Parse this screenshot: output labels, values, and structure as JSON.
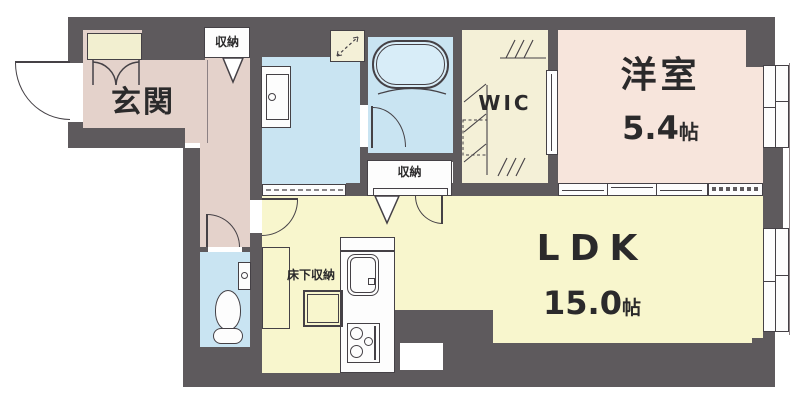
{
  "title": "apartment-floor-plan",
  "colors": {
    "wall": "#5e5a5d",
    "line": "#454146",
    "genkan": "#e4d2cb",
    "bedroom": "#f7e5dc",
    "ldk": "#f8f6cd",
    "wet": "#c9e4f2",
    "wic": "#f4f0d7",
    "cabinet": "#f2efd0",
    "tub": "#d8edf8"
  },
  "rooms": {
    "genkan": {
      "label": "玄関"
    },
    "hall_closet": {
      "label": "収納"
    },
    "bath_closet": {
      "label": "収納"
    },
    "wic": {
      "label": "WIC"
    },
    "bedroom": {
      "label": "洋室",
      "size": "5.4",
      "unit": "帖"
    },
    "ldk": {
      "label": "LDK",
      "size": "15.0",
      "unit": "帖"
    },
    "kitchen": {
      "underfloor_label": "床下収納"
    }
  }
}
